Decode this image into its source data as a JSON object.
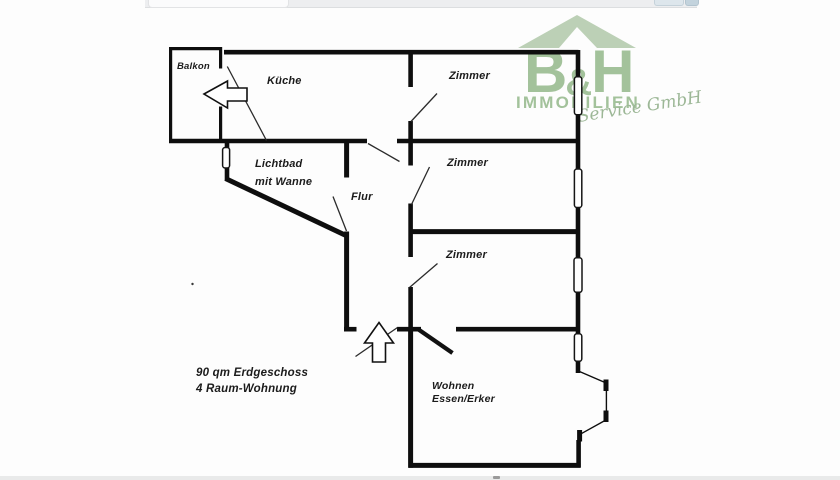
{
  "floor_plan": {
    "rooms": {
      "balkon": {
        "label": "Balkon"
      },
      "kueche": {
        "label": "Küche"
      },
      "zimmer_top": {
        "label": "Zimmer"
      },
      "zimmer_middle": {
        "label": "Zimmer"
      },
      "zimmer_bottom": {
        "label": "Zimmer"
      },
      "lichtbad": {
        "label_line1": "Lichtbad",
        "label_line2": "mit Wanne"
      },
      "flur": {
        "label": "Flur"
      },
      "wohnen": {
        "label_line1": "Wohnen",
        "label_line2": "Essen/Erker"
      }
    },
    "info": {
      "line1": "90 qm Erdgeschoss",
      "line2": "4 Raum-Wohnung"
    },
    "icons": {
      "entrance_arrow": "up-arrow (main entrance)",
      "balcony_arrow": "left-arrow (balcony door)",
      "window": "wall window marker"
    },
    "colors": {
      "wall": "#0e0e0e",
      "background": "#fdfdfd"
    }
  },
  "logo": {
    "letter_b": "B",
    "ampersand": "&",
    "letter_h": "H",
    "company": "IMMOBILIEN",
    "tagline": "Service GmbH",
    "colors": {
      "roof": "#b7cdb0",
      "letters": "#a3c29b",
      "tagline": "#9cb796"
    }
  }
}
